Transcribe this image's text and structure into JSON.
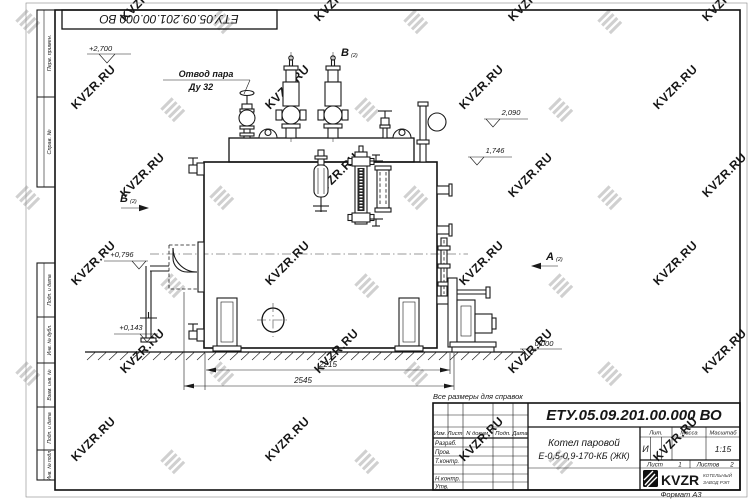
{
  "watermark": {
    "text": "KVZR.RU",
    "text_color": "#c3c3c3",
    "icon_color": "#d0d0d0"
  },
  "corner_stamp": {
    "doc_number": "ЕТУ.05.09.201.00.000  ВО"
  },
  "side_column": {
    "top": [
      "Перв. примен.",
      "Справ. №"
    ],
    "bottom": [
      "Подп. и дата",
      "Инв. № дубл.",
      "Взам. инв. №",
      "Подп. и дата",
      "Инв. № подл."
    ]
  },
  "annotations": {
    "steam_outlet_line1": "Отвод пара",
    "steam_outlet_line2": "Ду 32",
    "note": "Все размеры для справок",
    "view_a": "А",
    "view_b": "Б",
    "view_v": "В",
    "view_sub": "(2)"
  },
  "elevations": [
    "+2,700",
    "2,090",
    "1,746",
    "+0,796",
    "+0,143",
    "0,000"
  ],
  "dimensions": [
    "2215",
    "2545"
  ],
  "title_block": {
    "doc_number": "ЕТУ.05.09.201.00.000  ВО",
    "name_line1": "Котел паровой",
    "name_line2": "Е-0,5-0,9-170-КБ (ЖК)",
    "col_izm": "Изм.",
    "col_list": "Лист",
    "col_doc": "N докум.",
    "col_sign": "Подп.",
    "col_date": "Дата",
    "row_razrab": "Разраб.",
    "row_prov": "Пров.",
    "row_tkontr": "Т.контр.",
    "row_nkontr": "Н.контр.",
    "row_utv": "Утв.",
    "lit_header": "Лит.",
    "mass_header": "Масса",
    "scale_header": "Масштаб",
    "lit_value": "И",
    "scale_value": "1:15",
    "sheet_label": "Лист",
    "sheet_value": "1",
    "sheets_label": "Листов",
    "sheets_value": "2",
    "logo_text": "KVZR",
    "logo_sub1": "КОТЕЛЬНЫЙ",
    "logo_sub2": "ЗАВОД РЭП",
    "format_label": "Формат А3"
  }
}
